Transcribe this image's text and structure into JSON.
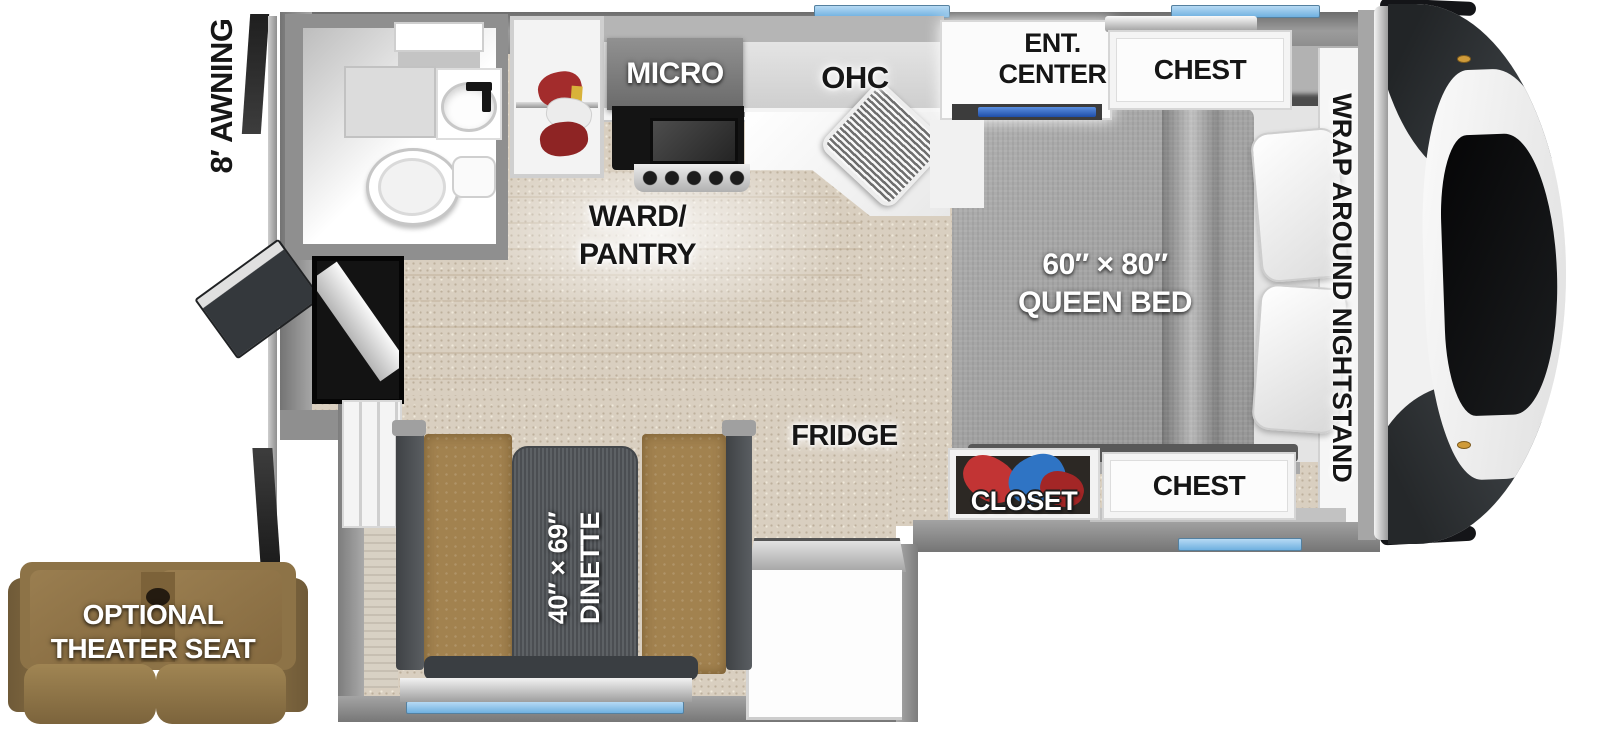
{
  "floorplan": {
    "awning": "8′ AWNING",
    "kitchen": {
      "micro": "MICRO",
      "ohc": "OHC",
      "ward_pantry_1": "WARD/",
      "ward_pantry_2": "PANTRY",
      "fridge": "FRIDGE"
    },
    "bedroom": {
      "ent_center_1": "ENT.",
      "ent_center_2": "CENTER",
      "chest_top": "CHEST",
      "nightstand": "WRAP AROUND NIGHTSTAND",
      "bed_size": "60″ × 80″",
      "bed_name": "QUEEN BED",
      "closet": "CLOSET",
      "chest_bottom": "CHEST"
    },
    "dinette": {
      "size": "40″ × 69″",
      "name": "DINETTE"
    },
    "theater": {
      "line1": "OPTIONAL",
      "line2": "THEATER SEAT"
    },
    "colors": {
      "window_blue": "#7db9e6",
      "wall_gray": "#8d8d8d",
      "carpet": "#d9cfc0",
      "wood_floor": "#eae1d0",
      "bench_brown": "#a2824f",
      "table_gray": "#53575b",
      "accent_blue": "#2458b8",
      "sofa_brown": "#8d7347",
      "bed_gray": "#a4a4a4"
    }
  }
}
